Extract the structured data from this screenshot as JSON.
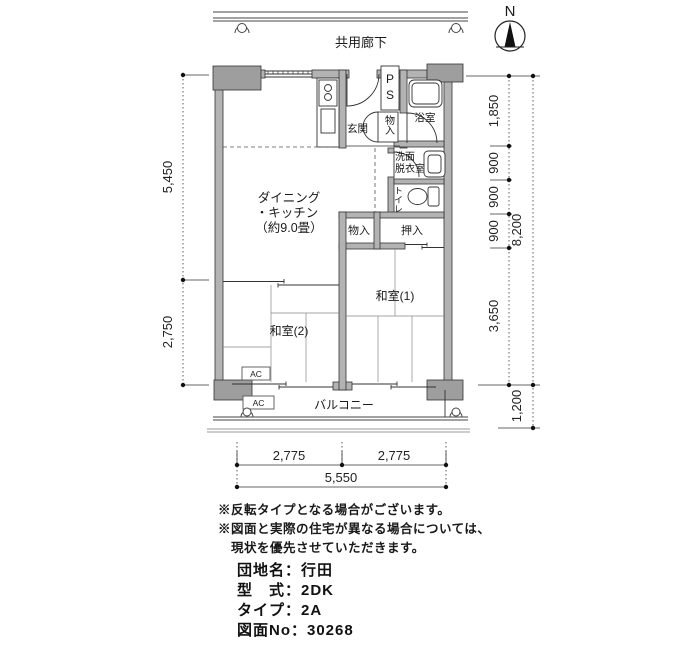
{
  "compass": {
    "north_label": "N"
  },
  "corridor_label": "共用廊下",
  "plan": {
    "rooms": {
      "dk_line1": "ダイニング",
      "dk_line2": "・キッチン",
      "dk_line3": "（約9.0畳）",
      "genkan": "玄関",
      "ps": "PS",
      "storage_upper": "物入",
      "bath": "浴室",
      "washroom_line1": "洗面",
      "washroom_line2": "脱衣室",
      "toilet": "トイレ",
      "storage": "物入",
      "oshiire": "押入",
      "japanese_room_1": "和室(1)",
      "japanese_room_2": "和室(2)",
      "balcony": "バルコニー",
      "ac_unit": "AC"
    }
  },
  "dimensions": {
    "left": [
      "5,450",
      "2,750"
    ],
    "right_inner": [
      "1,850",
      "900",
      "900",
      "900",
      "3,650"
    ],
    "right_total": "8,200",
    "right_balcony": "1,200",
    "bottom_halves": [
      "2,775",
      "2,775"
    ],
    "bottom_total": "5,550"
  },
  "notes": [
    "※反転タイプとなる場合がございます。",
    "※図面と実際の住宅が異なる場合については、",
    "　現状を優先させていただきます。"
  ],
  "property": {
    "line1": "団地名：行田",
    "line2": "型　式：2DK",
    "line3": "タイプ：2A",
    "line4": "図面No：30268"
  }
}
